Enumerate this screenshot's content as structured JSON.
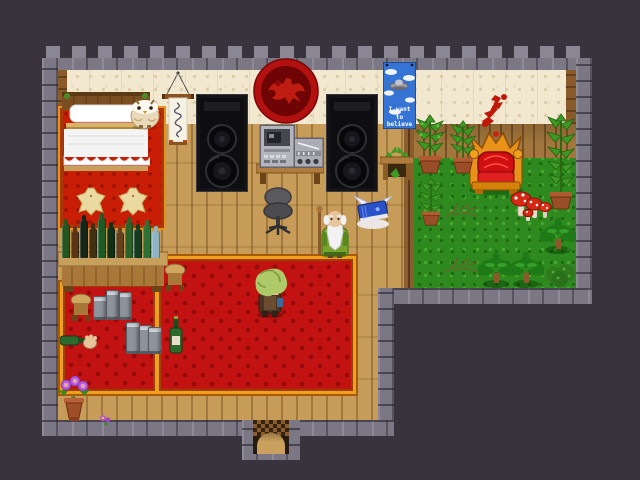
{
  "scene": {
    "description": "Top-down pixel-art RPG room with bed corner, stereo speakers, bar counter, large red carpet and indoor garden with throne",
    "poster": {
      "line1": "I want",
      "line2": "to believe"
    }
  },
  "palette": {
    "exterior": "#39333d",
    "stone_wall": "#7b7785",
    "wall_cream": "#f2e8d0",
    "floor_wood": "#c79c58",
    "grass": "#2e8a1e",
    "carpet_red": "#c21212",
    "carpet_trim_gold": "#f0a01c",
    "emblem_red": "#b81212",
    "throne_gold": "#e8921a",
    "throne_cushion": "#d01010",
    "poster_blue": "#3573d4",
    "mushroom_red": "#d62812",
    "flower_purple": "#b45ad0"
  },
  "counter": {
    "bottles": [
      {
        "color": "#245420",
        "h": 34
      },
      {
        "color": "#5c3513",
        "h": 27
      },
      {
        "color": "#15251a",
        "h": 38
      },
      {
        "color": "#423013",
        "h": 30
      },
      {
        "color": "#1e5a26",
        "h": 40
      },
      {
        "color": "#0f2f16",
        "h": 31
      },
      {
        "color": "#63411c",
        "h": 26
      },
      {
        "color": "#2c6128",
        "h": 36
      },
      {
        "color": "#163a20",
        "h": 29
      },
      {
        "color": "#2f7034",
        "h": 33
      },
      {
        "color": "#8fb4c4",
        "h": 27
      }
    ]
  },
  "entities": [
    "bed",
    "owl",
    "hanging-scroll",
    "speaker-left",
    "speaker-right",
    "wall-emblem",
    "stereo-desk",
    "office-chair",
    "ufo-poster",
    "side-table",
    "bar-counter",
    "stools",
    "hero",
    "old-man",
    "winged-book",
    "throne",
    "wall-splatter",
    "potted-plants",
    "mushrooms",
    "palm-trees",
    "bush",
    "twigs",
    "cans",
    "wine-bottle",
    "fallen-bottle",
    "flower-pot",
    "door"
  ]
}
